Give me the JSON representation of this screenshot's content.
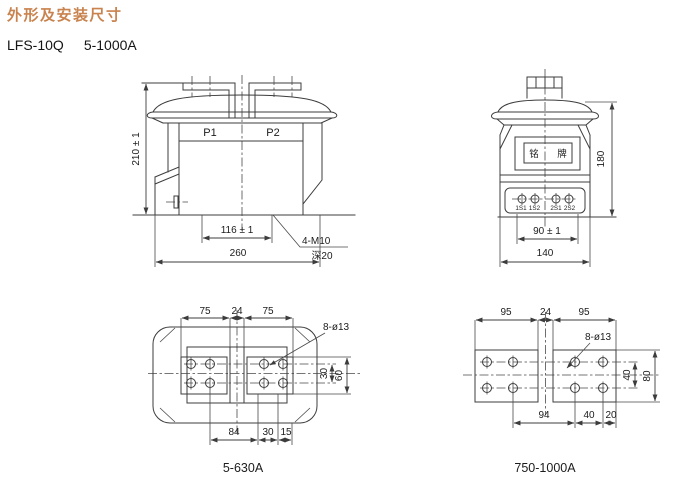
{
  "page": {
    "title": "外形及安装尺寸",
    "model": "LFS-10Q",
    "range": "5-1000A"
  },
  "colors": {
    "title_accent": "#c9834e",
    "line": "#3c3c3c",
    "text": "#1c1c1c"
  },
  "front_view": {
    "label_p1": "P1",
    "label_p2": "P2",
    "dim_height": "210 ± 1",
    "dim_hole_span": "116 ± 1",
    "dim_overall_width": "260",
    "thread_note": "4-M10",
    "depth_note": "深20"
  },
  "side_view": {
    "nameplate_left": "铭",
    "nameplate_right": "牌",
    "dim_height": "180",
    "terminal_labels": [
      "1S1",
      "1S2",
      "2S1",
      "2S2"
    ],
    "dim_terminal_span": "90 ± 1",
    "dim_overall_width": "140"
  },
  "base_view_5_630": {
    "caption": "5-630A",
    "dim_pad_left": "75",
    "dim_gap": "24",
    "dim_pad_right": "75",
    "holes_note": "8-ø13",
    "dim_hole_rows": "30",
    "dim_pad_height": "60",
    "dim_bottom_a": "84",
    "dim_bottom_b": "30",
    "dim_bottom_c": "15"
  },
  "base_view_750_1000": {
    "caption": "750-1000A",
    "dim_pad_left": "95",
    "dim_gap": "24",
    "dim_pad_right": "95",
    "holes_note": "8-ø13",
    "dim_hole_rows": "40",
    "dim_pad_height": "80",
    "dim_bottom_a": "94",
    "dim_bottom_b": "40",
    "dim_bottom_c": "20"
  }
}
